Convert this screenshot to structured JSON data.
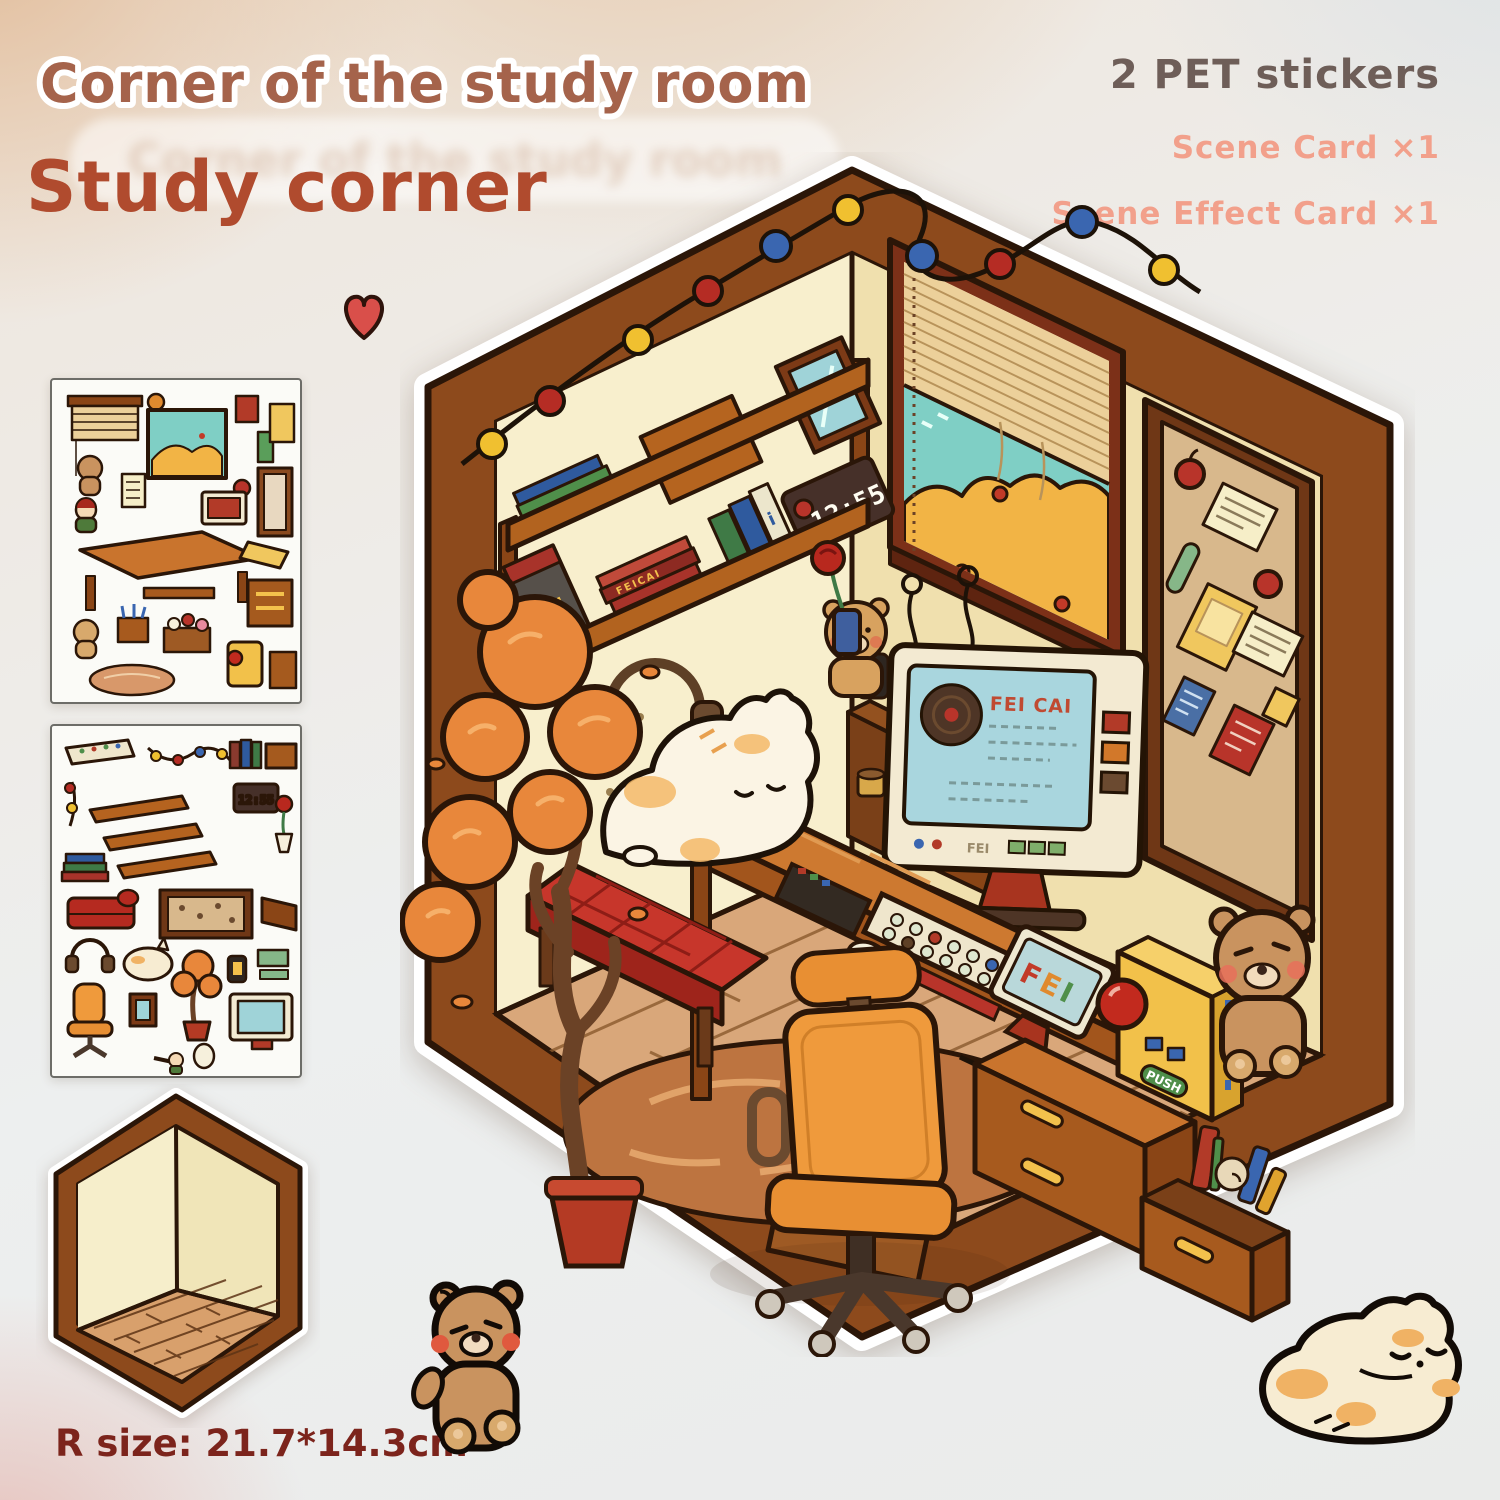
{
  "header": {
    "title_outline": "Corner of the study room",
    "title_main": "Study corner"
  },
  "contents": {
    "count_label": "2 PET stickers",
    "items": [
      {
        "label": "Scene Card",
        "qty": "×1"
      },
      {
        "label": "Scene Effect Card",
        "qty": "×1"
      }
    ]
  },
  "size_label": "R size: 21.7*14.3cm",
  "scene": {
    "clock_time": "12:55",
    "big_book_label": "FEI!",
    "book_stack_label": "FEICAI",
    "screen_title": "FEI CAI",
    "monitor_label": "FEI",
    "laptop_letters": [
      "F",
      "E",
      "I"
    ],
    "push_label": "PUSH"
  },
  "colors": {
    "title_outline_fill": "#a5634b",
    "title_main": "#b04b2e",
    "count_label": "#6e5e58",
    "card_text": "#f2a08b",
    "size_text": "#7c241c",
    "frame_brown": "#8d4a1c",
    "wall_left": "#f8efcd",
    "wall_right": "#f0e0ae",
    "floor_tan": "#d9a77a",
    "sky_teal": "#7fcfc5",
    "autumn_orange": "#e8873b",
    "desk_orange": "#cd7930",
    "chair_orange": "#ef9a3c",
    "bench_red": "#c7362b",
    "bulb_red": "#b52c24",
    "bulb_yellow": "#f0c030",
    "bulb_blue": "#3a66b0"
  }
}
